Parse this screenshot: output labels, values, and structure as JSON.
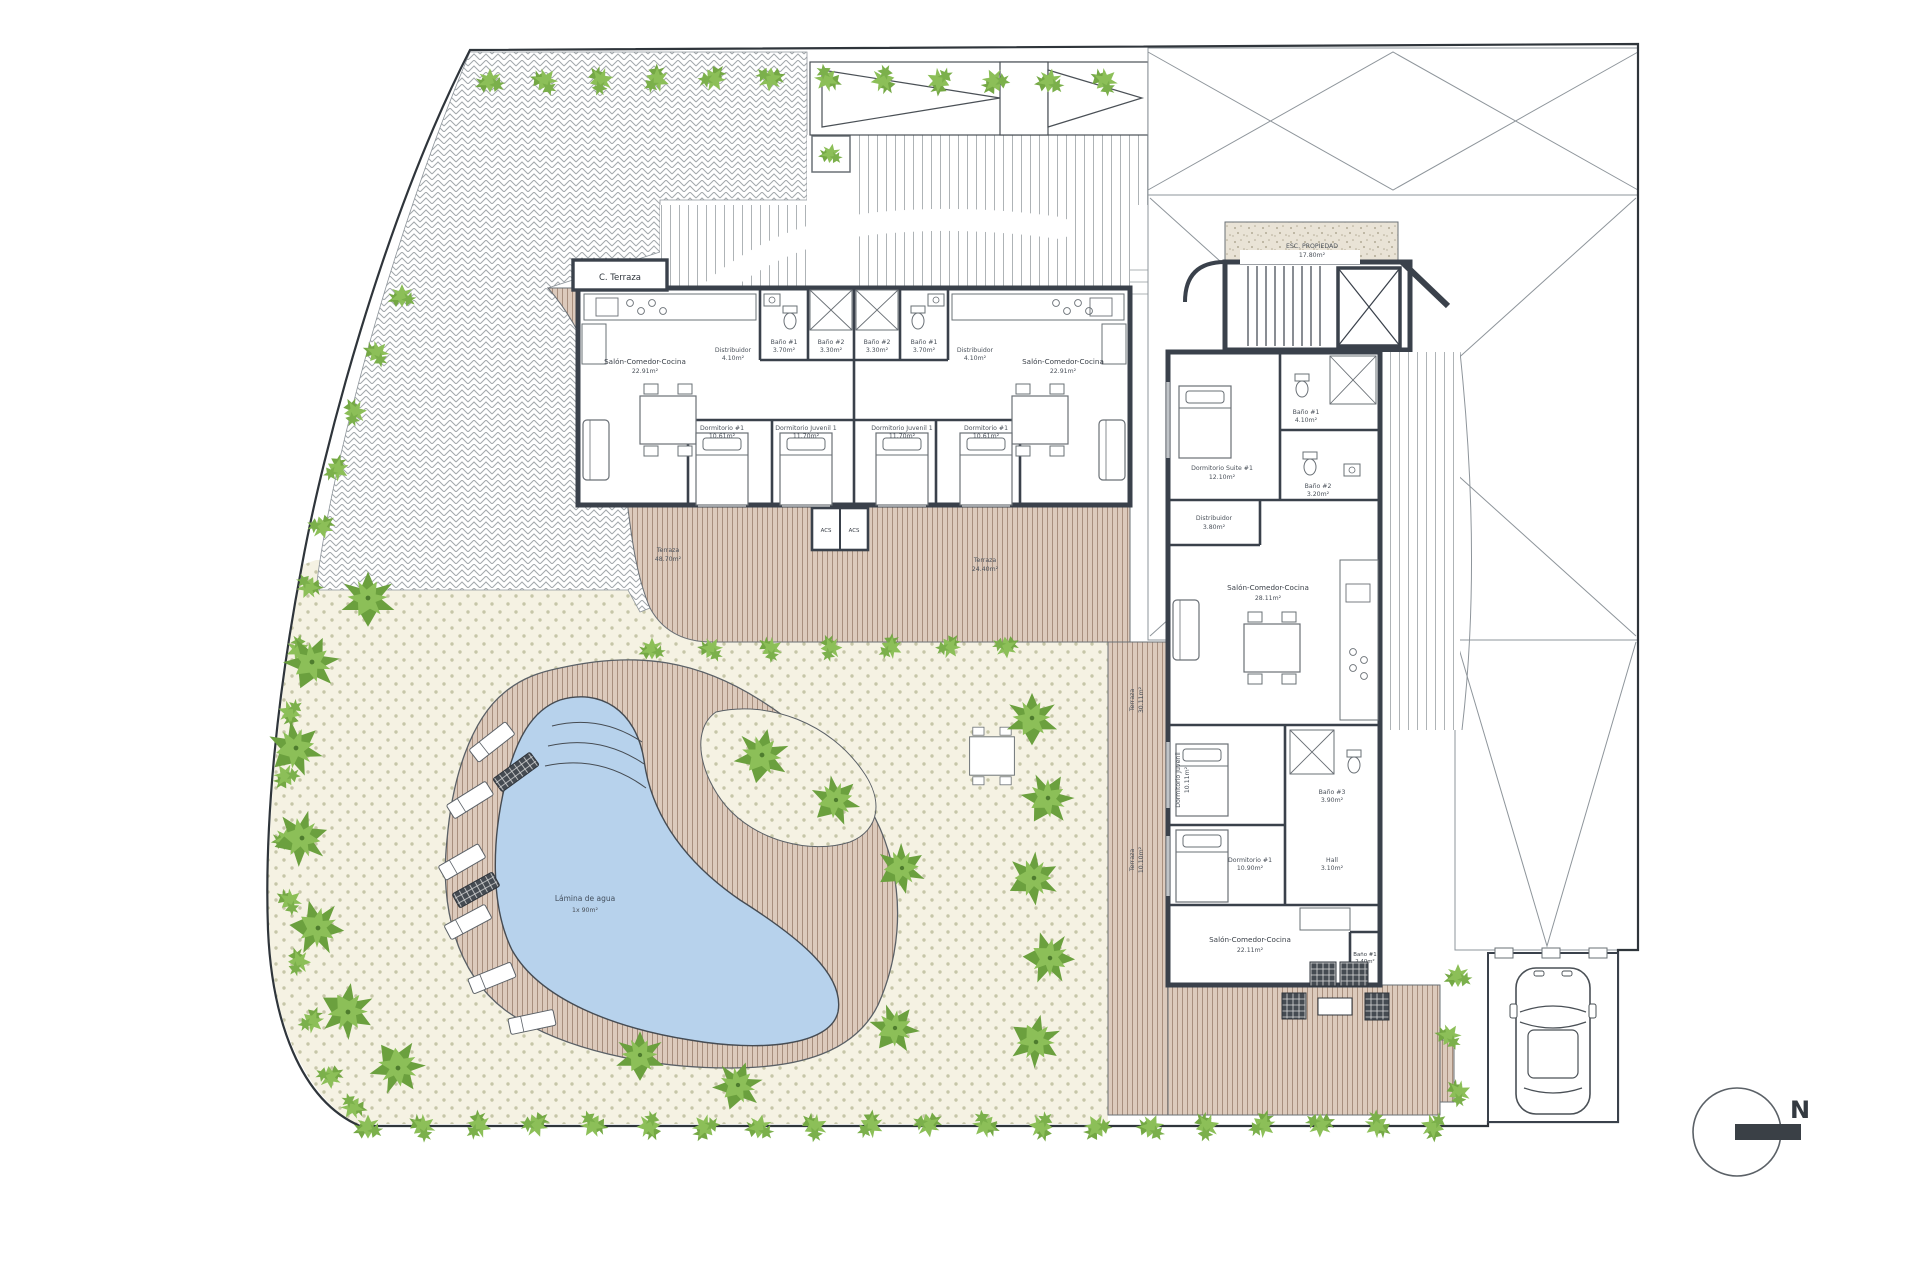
{
  "document": {
    "type": "residential-site-plan-ground-floor"
  },
  "colors": {
    "paper": "#ffffff",
    "wall": "#3a414b",
    "thin_line": "#8e959b",
    "terrace_base": "#dccabc",
    "terrace_stripe": "#a88f7e",
    "pool_water": "#b7d2ec",
    "garden_base": "#f5f2e3",
    "garden_dot": "#c6c6a8",
    "green_light": "#8cbf58",
    "green_dark": "#6ba03e",
    "sand": "#e9e3d6"
  },
  "labels": {
    "c_terraza": "C. Terraza",
    "stair_name": "ESC. PROPIEDAD",
    "stair_area": "17.80m²",
    "pool_name": "Lámina de agua",
    "pool_area": "1x 90m²",
    "north": "N",
    "acs": "ACS"
  },
  "terraces": [
    {
      "name": "Terraza",
      "area": "48.70m²"
    },
    {
      "name": "Terraza",
      "area": "24.40m²"
    },
    {
      "name": "Terraza",
      "area": "30.11m²"
    },
    {
      "name": "Terraza",
      "area": "10.10m²"
    }
  ],
  "unit_a": {
    "salon_name": "Salón-Comedor-Cocina",
    "salon_area": "22.91m²",
    "distribuidor_name": "Distribuidor",
    "distribuidor_area": "4.10m²",
    "bano1_name": "Baño #1",
    "bano1_area": "3.70m²",
    "bano2_name": "Baño #2",
    "bano2_area": "3.30m²",
    "dorm1_name": "Dormitorio #1",
    "dorm1_area": "10.61m²",
    "dorm2_name": "Dormitorio Juvenil 1",
    "dorm2_area": "11.70m²"
  },
  "unit_b": {
    "salon_name": "Salón-Comedor-Cocina",
    "salon_area": "22.91m²",
    "distribuidor_name": "Distribuidor",
    "distribuidor_area": "4.10m²",
    "bano1_name": "Baño #1",
    "bano1_area": "3.70m²",
    "bano2_name": "Baño #2",
    "bano2_area": "3.30m²",
    "dorm1_name": "Dormitorio #1",
    "dorm1_area": "10.61m²",
    "dorm2_name": "Dormitorio Juvenil 1",
    "dorm2_area": "11.70m²"
  },
  "wing": {
    "suite_name": "Dormitorio Suite #1",
    "suite_area": "12.10m²",
    "bano1_name": "Baño #1",
    "bano1_area": "4.10m²",
    "bano2_name": "Baño #2",
    "bano2_area": "3.20m²",
    "distribuidor_name": "Distribuidor",
    "distribuidor_area": "3.80m²",
    "salon_name": "Salón-Comedor-Cocina",
    "salon_area": "28.11m²",
    "dorm_juvenil_name": "Dormitorio Juvenil",
    "dorm_juvenil_area": "10.11m²",
    "bano3_name": "Baño #3",
    "bano3_area": "3.90m²",
    "dorm1_name": "Dormitorio #1",
    "dorm1_area": "10.90m²",
    "hall_name": "Hall",
    "hall_area": "3.10m²",
    "salon2_name": "Salón-Comedor-Cocina",
    "salon2_area": "22.11m²",
    "bano4_name": "Baño #1",
    "bano4_area": "2.40m²"
  }
}
